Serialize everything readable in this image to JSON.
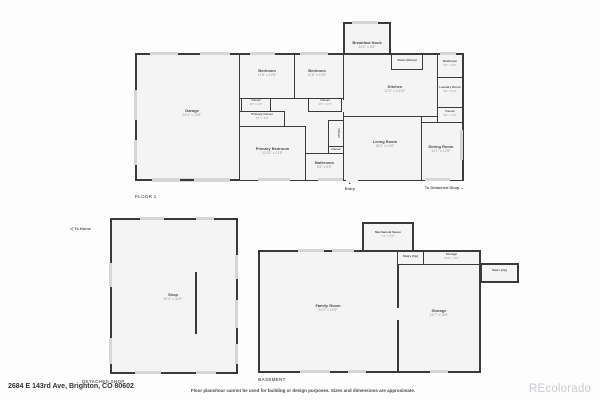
{
  "colors": {
    "wall": "#3a3a3a",
    "room_fill": "#f4f4f4",
    "window": "#d6d6d6",
    "watermark_gray": "#c9ccd0"
  },
  "icons": {
    "entry_arrow": "▲",
    "down_arrow": "⌄",
    "left_arrow": "◁"
  },
  "floor1": {
    "title": "FLOOR 1",
    "rooms": {
      "garage": {
        "name": "Garage",
        "dims": "23'4\" x 23'6\""
      },
      "bedroom1": {
        "name": "Bedroom",
        "dims": "11'8\" x 12'6\""
      },
      "bedroom2": {
        "name": "Bedroom",
        "dims": "11'6\" x 12'6\""
      },
      "closet1": {
        "name": "Closet",
        "dims": "4'0\" x 2'0\""
      },
      "closet2": {
        "name": "Closet",
        "dims": "4'6\" x 2'0\""
      },
      "primary_closet": {
        "name": "Primary Closet",
        "dims": "7'6\" x 3'6\""
      },
      "primary_bedroom": {
        "name": "Primary Bedroom",
        "dims": "12'10\" x 11'6\""
      },
      "closet_tall": {
        "name": "Closet"
      },
      "closet_small": {
        "name": "Closet"
      },
      "bathroom_main": {
        "name": "Bathroom",
        "dims": "8'6\" x 6'0\""
      },
      "breakfast_nook": {
        "name": "Breakfast Nook",
        "dims": "10'0\" x 8'6\""
      },
      "kitchen": {
        "name": "Kitchen",
        "dims": "12'2\" x 14'10\""
      },
      "stairs_down": {
        "name": "Stairs (Down)"
      },
      "bathroom_top": {
        "name": "Bathroom",
        "dims": "5'0\" x 8'0\""
      },
      "laundry": {
        "name": "Laundry Room",
        "dims": "5'0\" x 5'2\""
      },
      "closet3": {
        "name": "Closet",
        "dims": "5'0\" x 2'0\""
      },
      "living": {
        "name": "Living Room",
        "dims": "18'2\" x 14'6\""
      },
      "dining": {
        "name": "Dining Room",
        "dims": "11'1\" x 12'8\""
      }
    },
    "annotations": {
      "entry": "Entry",
      "to_detached_shop": "To Detached Shop"
    }
  },
  "detached_shop": {
    "title": "DETACHED SHOP",
    "to_home": "To Home",
    "rooms": {
      "shop": {
        "name": "Shop",
        "dims": "30'4\" x 32'0\""
      }
    }
  },
  "basement": {
    "title": "BASEMENT",
    "rooms": {
      "mechanical": {
        "name": "Mechanical Space",
        "dims": "7'0\" x 6'5\""
      },
      "stairs_up1": {
        "name": "Stairs (Up)"
      },
      "storage_top": {
        "name": "Storage",
        "dims": "10'6\" x 3'1\""
      },
      "stairs_up2": {
        "name": "Stairs (Up)"
      },
      "family": {
        "name": "Family Room",
        "dims": "24'3\" x 24'9\""
      },
      "storage": {
        "name": "Storage",
        "dims": "14'7\" x 18'9\""
      }
    }
  },
  "footer": {
    "address": "2684 E 143rd Ave, Brighton, CO 80602",
    "disclaimer": "Floor plans/tour cannot be used for building or design purposes. Sizes and dimensions are approximate.",
    "watermark": "REcolorado"
  }
}
